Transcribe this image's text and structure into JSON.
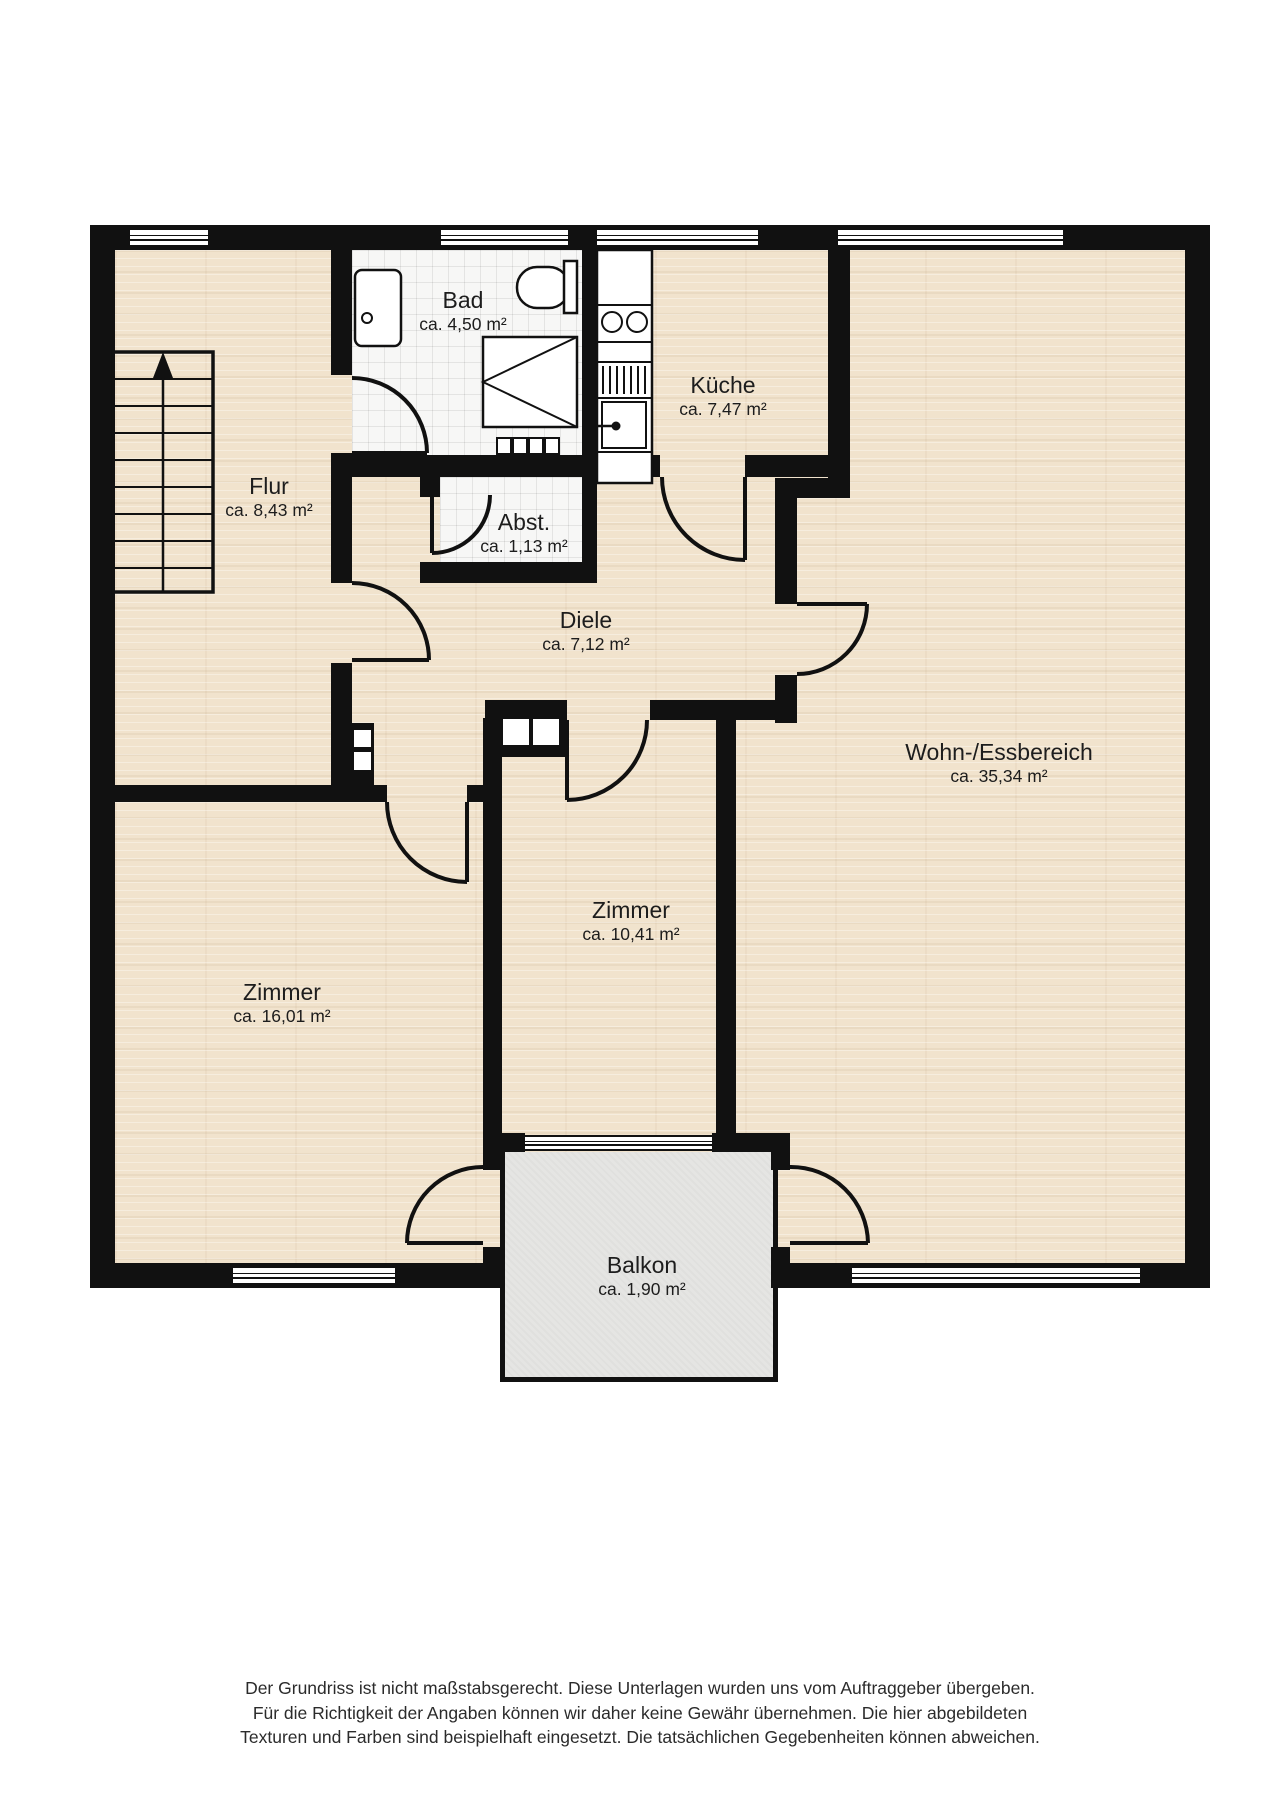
{
  "title": "Grundriss",
  "rooms": {
    "flur": {
      "name": "Flur",
      "area": "ca. 8,43 m²"
    },
    "bad": {
      "name": "Bad",
      "area": "ca. 4,50 m²"
    },
    "kueche": {
      "name": "Küche",
      "area": "ca. 7,47 m²"
    },
    "abst": {
      "name": "Abst.",
      "area": "ca. 1,13 m²"
    },
    "diele": {
      "name": "Diele",
      "area": "ca. 7,12 m²"
    },
    "wohn": {
      "name": "Wohn-/Essbereich",
      "area": "ca. 35,34 m²"
    },
    "zimmer_klein": {
      "name": "Zimmer",
      "area": "ca. 10,41 m²"
    },
    "zimmer_gross": {
      "name": "Zimmer",
      "area": "ca. 16,01 m²"
    },
    "balkon": {
      "name": "Balkon",
      "area": "ca. 1,90 m²"
    }
  },
  "colors": {
    "wall": "#111111",
    "wood_floor": "#f1e3cd",
    "tile_floor": "#f7f7f6",
    "balcony_floor": "#e5e5e3",
    "background": "#ffffff"
  },
  "disclaimer": {
    "line1": "Der Grundriss ist nicht maßstabsgerecht. Diese Unterlagen wurden uns vom Auftraggeber übergeben.",
    "line2": "Für die Richtigkeit der Angaben können wir daher keine Gewähr übernehmen. Die hier abgebildeten",
    "line3": "Texturen und Farben sind beispielhaft eingesetzt. Die tatsächlichen Gegebenheiten können abweichen."
  }
}
